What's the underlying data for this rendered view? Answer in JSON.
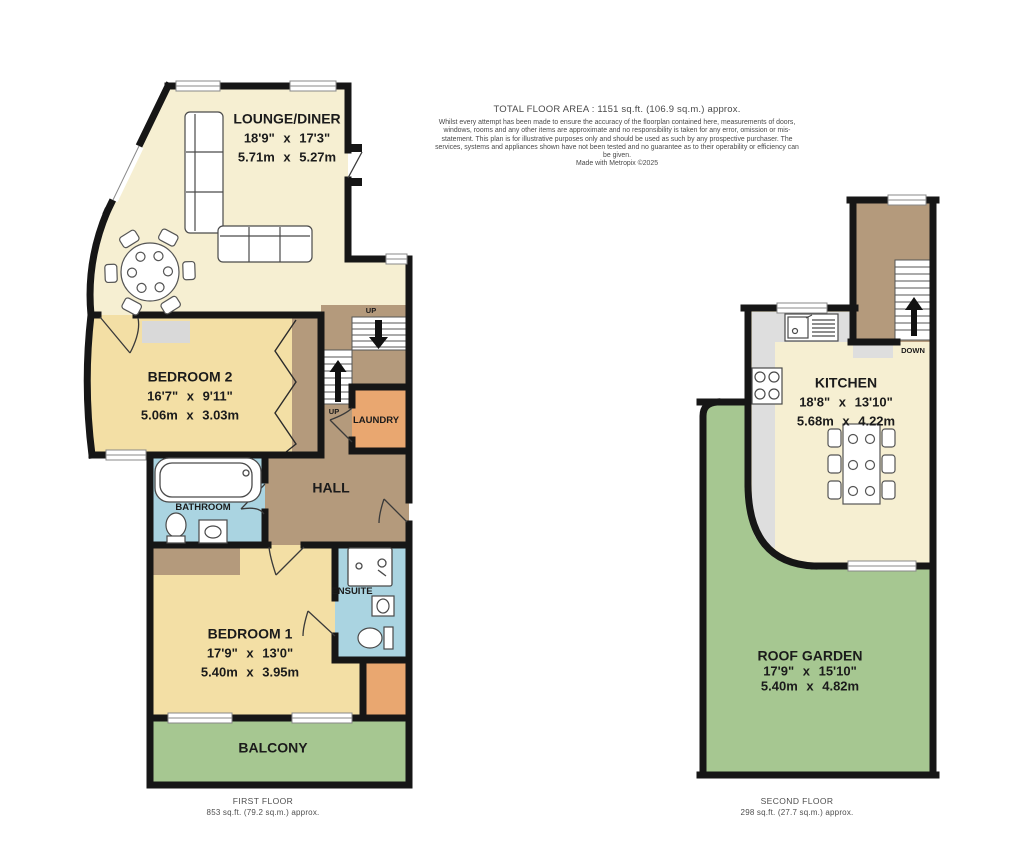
{
  "disclaimer": {
    "title": "TOTAL FLOOR AREA : 1151 sq.ft. (106.9 sq.m.) approx.",
    "body": "Whilst every attempt has been made to ensure the accuracy of the floorplan contained here, measurements of doors, windows, rooms and any other items are approximate and no responsibility is taken for any error, omission or mis-statement. This plan is for illustrative purposes only and should be used as such by any prospective purchaser. The services, systems and appliances shown have not been tested and no guarantee as to their operability or efficiency can be given.",
    "credit": "Made with Metropix ©2025"
  },
  "first_floor": {
    "caption_title": "FIRST FLOOR",
    "caption_area": "853 sq.ft. (79.2 sq.m.) approx.",
    "rooms": {
      "lounge": {
        "name": "LOUNGE/DINER",
        "imperial": "18'9\" x 17'3\"",
        "metric": "5.71m x 5.27m"
      },
      "bedroom2": {
        "name": "BEDROOM 2",
        "imperial": "16'7\" x 9'11\"",
        "metric": "5.06m x 3.03m"
      },
      "bedroom1": {
        "name": "BEDROOM 1",
        "imperial": "17'9\" x 13'0\"",
        "metric": "5.40m x 3.95m"
      },
      "bathroom": {
        "name": "BATHROOM"
      },
      "ensuite": {
        "name": "ENSUITE"
      },
      "hall": {
        "name": "HALL"
      },
      "laundry": {
        "name": "LAUNDRY"
      },
      "balcony": {
        "name": "BALCONY"
      }
    },
    "stairs": {
      "up_upper": "UP",
      "up_lower": "UP"
    }
  },
  "second_floor": {
    "caption_title": "SECOND FLOOR",
    "caption_area": "298 sq.ft. (27.7 sq.m.) approx.",
    "rooms": {
      "kitchen": {
        "name": "KITCHEN",
        "imperial": "18'8\" x 13'10\"",
        "metric": "5.68m x 4.22m"
      },
      "garden": {
        "name": "ROOF GARDEN",
        "imperial": "17'9\" x 15'10\"",
        "metric": "5.40m x 4.82m"
      }
    },
    "stairs": {
      "down": "DOWN"
    }
  },
  "colors": {
    "wall": "#161616",
    "cream": "#f6efd2",
    "yellow": "#f3dfa5",
    "brown": "#b49a7c",
    "orange": "#e9a770",
    "blue": "#aad4e1",
    "green": "#a6c791",
    "counter": "#dedede",
    "rug": "#d9d9d9",
    "furniture_stroke": "#4a4a4a"
  }
}
